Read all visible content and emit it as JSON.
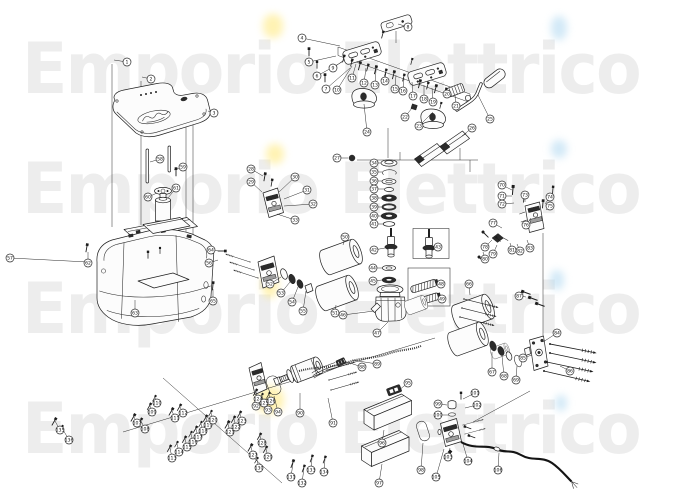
{
  "watermark": {
    "text": "Emporio Elettrico",
    "color": "#ededed",
    "row_tops": [
      34,
      154,
      274,
      394
    ]
  },
  "highlights": {
    "yellow": {
      "color": "#ffe876",
      "spots": [
        [
          263,
          14,
          20,
          24
        ],
        [
          266,
          144,
          18,
          20
        ],
        [
          262,
          272,
          16,
          26
        ],
        [
          256,
          386,
          28,
          28
        ]
      ]
    },
    "blue": {
      "color": "#aed7f0",
      "spots": [
        [
          551,
          16,
          16,
          24
        ],
        [
          551,
          140,
          16,
          18
        ],
        [
          550,
          270,
          14,
          20
        ],
        [
          555,
          395,
          12,
          16
        ]
      ]
    }
  },
  "diagram": {
    "stroke": "#2a2a2a",
    "lines": [
      [
        112,
        64,
        112,
        227
      ],
      [
        141,
        81,
        141,
        225
      ],
      [
        186,
        98,
        186,
        288
      ],
      [
        193,
        98,
        193,
        283
      ],
      [
        543,
        233,
        543,
        336
      ],
      [
        388,
        128,
        388,
        158
      ],
      [
        357,
        160,
        478,
        160
      ],
      [
        400,
        160,
        400,
        152
      ],
      [
        460,
        160,
        460,
        148
      ],
      [
        470,
        160,
        470,
        172
      ],
      [
        123,
        432,
        435,
        338
      ],
      [
        163,
        378,
        282,
        483
      ],
      [
        530,
        391,
        473,
        422
      ],
      [
        396,
        31,
        396,
        43
      ],
      [
        338,
        47,
        470,
        94
      ],
      [
        338,
        55.5,
        470,
        102.5
      ],
      [
        338,
        47,
        338,
        55.5
      ],
      [
        470,
        94,
        470,
        102.5
      ]
    ],
    "screws": [
      [
        344,
        57,
        15,
        0.8
      ],
      [
        352,
        61,
        15,
        0.8
      ],
      [
        360,
        64,
        15,
        0.9
      ],
      [
        368,
        66,
        15,
        0.8
      ],
      [
        376,
        68,
        15,
        0.9
      ],
      [
        386,
        71,
        15,
        0.8
      ],
      [
        394,
        73,
        15,
        0.9
      ],
      [
        404,
        76,
        15,
        0.8
      ],
      [
        420,
        82,
        15,
        0.9
      ],
      [
        428,
        84,
        15,
        0.8
      ],
      [
        436,
        87,
        15,
        0.9
      ],
      [
        446,
        90,
        15,
        0.8
      ],
      [
        383,
        33,
        15,
        0.8
      ],
      [
        412,
        60,
        15,
        0.7
      ],
      [
        309,
        50,
        0,
        0.9
      ],
      [
        317,
        63,
        0,
        0.8
      ],
      [
        325,
        76,
        0,
        0.9
      ],
      [
        176,
        170,
        0,
        0.9
      ],
      [
        148,
        253,
        0,
        0.8
      ],
      [
        160,
        249,
        0,
        0.7
      ],
      [
        87,
        246,
        10,
        0.9
      ],
      [
        224,
        251,
        90,
        0.9
      ],
      [
        213,
        284,
        5,
        0.9
      ],
      [
        265,
        175,
        10,
        0.9
      ],
      [
        272,
        181,
        10,
        0.8
      ],
      [
        513,
        188,
        5,
        1
      ],
      [
        524,
        197,
        5,
        0.8
      ],
      [
        543,
        202,
        5,
        0.9
      ],
      [
        553,
        188,
        5,
        0.8
      ],
      [
        484,
        233,
        -45,
        0.9
      ],
      [
        497,
        238,
        -45,
        0.7
      ],
      [
        480,
        258,
        -45,
        0.9
      ],
      [
        524,
        292,
        -70,
        1
      ],
      [
        531,
        298,
        -70,
        1
      ],
      [
        538,
        304,
        -70,
        1
      ],
      [
        134,
        416,
        30,
        0.9
      ],
      [
        141,
        420,
        30,
        0.8
      ],
      [
        150,
        405,
        30,
        0.8
      ],
      [
        155,
        397,
        30,
        0.7
      ],
      [
        172,
        410,
        30,
        0.9
      ],
      [
        180,
        406,
        30,
        0.8
      ],
      [
        170,
        447,
        30,
        0.8
      ],
      [
        177,
        443,
        30,
        0.7
      ],
      [
        185,
        438,
        30,
        0.8
      ],
      [
        191,
        433,
        30,
        0.7
      ],
      [
        196,
        428,
        30,
        0.8
      ],
      [
        201,
        423,
        30,
        0.7
      ],
      [
        206,
        417,
        30,
        0.8
      ],
      [
        211,
        412,
        30,
        0.7
      ],
      [
        228,
        423,
        30,
        0.9
      ],
      [
        234,
        418,
        30,
        0.8
      ],
      [
        240,
        413,
        30,
        0.8
      ],
      [
        256,
        391,
        30,
        0.8
      ],
      [
        262,
        395,
        30,
        0.7
      ],
      [
        269,
        394,
        30,
        0.7
      ],
      [
        251,
        446,
        30,
        0.9
      ],
      [
        260,
        435,
        30,
        0.8
      ],
      [
        266,
        448,
        30,
        0.8
      ],
      [
        257,
        459,
        30,
        0.7
      ],
      [
        55,
        420,
        30,
        0.9
      ],
      [
        62,
        427,
        30,
        0.7
      ],
      [
        293,
        462,
        20,
        0.9
      ],
      [
        304,
        467,
        20,
        0.8
      ],
      [
        312,
        457,
        20,
        0.8
      ],
      [
        325,
        458,
        20,
        0.8
      ],
      [
        466,
        427,
        -70,
        0.8
      ],
      [
        470,
        436,
        -70,
        0.8
      ],
      [
        449,
        453,
        40,
        1.1
      ],
      [
        461,
        394,
        0,
        0.8
      ],
      [
        441,
        104,
        15,
        0.7
      ]
    ],
    "bolts": [
      [
        550,
        344,
        11,
        1
      ],
      [
        550,
        353,
        12,
        1
      ],
      [
        547,
        362,
        12,
        1
      ],
      [
        544,
        371,
        13,
        1
      ],
      [
        464,
        299,
        14,
        0.75
      ],
      [
        462,
        308,
        14,
        0.75
      ],
      [
        460,
        317,
        14,
        0.75
      ],
      [
        327,
        370,
        -16,
        0.62
      ],
      [
        329,
        380,
        -16,
        0.62
      ],
      [
        331,
        390,
        -16,
        0.62
      ],
      [
        250,
        262,
        -162,
        0.55
      ],
      [
        254,
        270,
        -162,
        0.55
      ],
      [
        258,
        278,
        -162,
        0.55
      ],
      [
        463,
        425,
        -15,
        0.45
      ],
      [
        465,
        434,
        -15,
        0.45
      ]
    ],
    "callouts": [
      [
        1,
        127,
        62,
        114,
        60
      ],
      [
        2,
        151,
        79,
        142,
        77
      ],
      [
        3,
        214,
        113,
        208,
        111
      ],
      [
        4,
        302,
        38,
        340,
        46
      ],
      [
        5,
        309,
        62,
        336,
        56
      ],
      [
        6,
        317,
        76,
        342,
        62
      ],
      [
        7,
        326,
        89,
        350,
        68
      ],
      [
        8,
        408,
        27,
        398,
        24
      ],
      [
        9,
        333,
        68,
        344,
        60
      ],
      [
        10,
        337,
        90,
        352,
        66
      ],
      [
        11,
        352,
        78,
        356,
        64
      ],
      [
        12,
        364,
        83,
        366,
        68
      ],
      [
        13,
        375,
        85,
        376,
        70
      ],
      [
        14,
        385,
        81,
        386,
        72
      ],
      [
        15,
        395,
        89,
        396,
        75
      ],
      [
        16,
        403,
        91,
        404,
        78
      ],
      [
        17,
        413,
        96,
        412,
        82
      ],
      [
        18,
        424,
        99,
        424,
        85
      ],
      [
        19,
        433,
        102,
        432,
        88
      ],
      [
        20,
        447,
        94,
        448,
        90
      ],
      [
        21,
        456,
        106,
        455,
        95
      ],
      [
        22,
        405,
        117,
        412,
        108
      ],
      [
        23,
        419,
        126,
        433,
        112
      ],
      [
        24,
        367,
        132,
        364,
        104
      ],
      [
        25,
        490,
        119,
        478,
        95
      ],
      [
        26,
        472,
        128,
        462,
        136
      ],
      [
        27,
        337,
        158,
        348,
        158
      ],
      [
        28,
        251,
        169,
        263,
        176
      ],
      [
        29,
        251,
        182,
        262,
        192
      ],
      [
        30,
        295,
        177,
        279,
        192
      ],
      [
        31,
        307,
        190,
        284,
        199
      ],
      [
        32,
        313,
        204,
        284,
        206
      ],
      [
        33,
        295,
        220,
        277,
        214
      ],
      [
        34,
        374,
        163,
        381,
        163
      ],
      [
        35,
        374,
        172,
        382,
        172
      ],
      [
        36,
        374,
        181,
        382,
        181
      ],
      [
        37,
        374,
        189,
        384,
        189
      ],
      [
        38,
        374,
        198,
        381,
        198
      ],
      [
        39,
        374,
        207,
        382,
        207
      ],
      [
        40,
        374,
        216,
        381,
        216
      ],
      [
        41,
        374,
        224,
        383,
        224
      ],
      [
        42,
        374,
        250,
        385,
        248
      ],
      [
        43,
        438,
        247,
        434,
        247
      ],
      [
        44,
        373,
        268,
        382,
        268
      ],
      [
        45,
        373,
        281,
        382,
        280
      ],
      [
        46,
        343,
        315,
        374,
        311
      ],
      [
        47,
        377,
        333,
        388,
        322
      ],
      [
        48,
        441,
        284,
        437,
        281
      ],
      [
        49,
        442,
        299,
        440,
        296
      ],
      [
        50,
        345,
        237,
        343,
        245
      ],
      [
        51,
        335,
        313,
        336,
        305
      ],
      [
        52,
        270,
        284,
        281,
        277
      ],
      [
        53,
        281,
        293,
        290,
        282
      ],
      [
        54,
        292,
        302,
        298,
        287
      ],
      [
        55,
        303,
        311,
        306,
        291
      ],
      [
        56,
        209,
        263,
        218,
        260
      ],
      [
        57,
        10,
        258,
        88,
        262
      ],
      [
        58,
        160,
        159,
        150,
        162
      ],
      [
        59,
        183,
        167,
        174,
        170
      ],
      [
        60,
        148,
        197,
        157,
        193
      ],
      [
        61,
        176,
        188,
        168,
        198
      ],
      [
        62,
        88,
        263,
        88,
        252
      ],
      [
        63,
        135,
        313,
        135,
        300
      ],
      [
        64,
        211,
        250,
        220,
        251
      ],
      [
        65,
        213,
        301,
        213,
        289
      ],
      [
        66,
        469,
        284,
        470,
        295
      ],
      [
        67,
        492,
        372,
        492,
        352
      ],
      [
        68,
        504,
        376,
        502,
        356
      ],
      [
        69,
        516,
        380,
        517,
        366
      ],
      [
        70,
        502,
        185,
        512,
        190
      ],
      [
        71,
        502,
        196,
        512,
        196
      ],
      [
        72,
        502,
        204,
        514,
        203
      ],
      [
        73,
        525,
        195,
        525,
        202
      ],
      [
        74,
        550,
        197,
        545,
        204
      ],
      [
        75,
        550,
        206,
        546,
        210
      ],
      [
        76,
        526,
        225,
        531,
        218
      ],
      [
        77,
        493,
        223,
        502,
        228
      ],
      [
        78,
        485,
        247,
        492,
        240
      ],
      [
        79,
        493,
        254,
        497,
        245
      ],
      [
        80,
        485,
        259,
        483,
        252
      ],
      [
        81,
        512,
        250,
        510,
        243
      ],
      [
        82,
        520,
        251,
        517,
        244
      ],
      [
        83,
        530,
        248,
        527,
        240
      ],
      [
        84,
        557,
        333,
        543,
        342
      ],
      [
        85,
        523,
        358,
        532,
        355
      ],
      [
        86,
        570,
        371,
        560,
        366
      ],
      [
        87,
        519,
        296,
        526,
        297
      ],
      [
        88,
        362,
        367,
        347,
        362
      ],
      [
        89,
        377,
        364,
        352,
        360
      ],
      [
        90,
        300,
        413,
        300,
        393
      ],
      [
        91,
        333,
        423,
        328,
        398
      ],
      [
        92,
        256,
        406,
        256,
        396
      ],
      [
        93,
        268,
        410,
        266,
        398
      ],
      [
        94,
        278,
        412,
        274,
        396
      ],
      [
        95,
        408,
        383,
        399,
        390
      ],
      [
        96,
        382,
        443,
        384,
        430
      ],
      [
        97,
        379,
        483,
        382,
        464
      ],
      [
        98,
        421,
        470,
        423,
        443
      ],
      [
        99,
        438,
        404,
        447,
        405
      ],
      [
        100,
        438,
        415,
        449,
        415
      ],
      [
        101,
        475,
        393,
        463,
        399
      ],
      [
        102,
        477,
        405,
        465,
        408
      ],
      [
        103,
        448,
        457,
        450,
        448
      ],
      [
        104,
        468,
        461,
        463,
        444
      ],
      [
        105,
        436,
        477,
        444,
        449
      ],
      [
        106,
        498,
        470,
        499,
        453
      ],
      [
        107,
        137,
        423,
        134,
        417
      ],
      [
        108,
        145,
        429,
        141,
        421
      ],
      [
        109,
        152,
        412,
        150,
        406
      ],
      [
        110,
        157,
        403,
        155,
        398
      ],
      [
        111,
        175,
        418,
        172,
        411
      ],
      [
        112,
        183,
        413,
        180,
        407
      ],
      [
        113,
        172,
        458,
        170,
        448
      ],
      [
        114,
        179,
        452,
        177,
        444
      ],
      [
        115,
        187,
        447,
        185,
        439
      ],
      [
        116,
        193,
        442,
        191,
        434
      ],
      [
        117,
        198,
        437,
        196,
        429
      ],
      [
        118,
        203,
        431,
        201,
        424
      ],
      [
        119,
        208,
        425,
        206,
        418
      ],
      [
        120,
        213,
        420,
        211,
        413
      ],
      [
        121,
        230,
        432,
        228,
        424
      ],
      [
        122,
        236,
        427,
        234,
        419
      ],
      [
        123,
        242,
        421,
        240,
        414
      ],
      [
        124,
        258,
        399,
        256,
        392
      ],
      [
        125,
        264,
        403,
        262,
        396
      ],
      [
        126,
        271,
        401,
        269,
        395
      ],
      [
        127,
        253,
        455,
        251,
        447
      ],
      [
        128,
        262,
        443,
        260,
        436
      ],
      [
        129,
        268,
        457,
        266,
        449
      ],
      [
        130,
        259,
        468,
        257,
        460
      ],
      [
        131,
        291,
        477,
        293,
        463
      ],
      [
        132,
        302,
        483,
        304,
        468
      ],
      [
        133,
        311,
        470,
        312,
        458
      ],
      [
        134,
        324,
        472,
        325,
        459
      ],
      [
        135,
        60,
        430,
        55,
        421
      ],
      [
        136,
        69,
        440,
        62,
        428
      ]
    ]
  }
}
